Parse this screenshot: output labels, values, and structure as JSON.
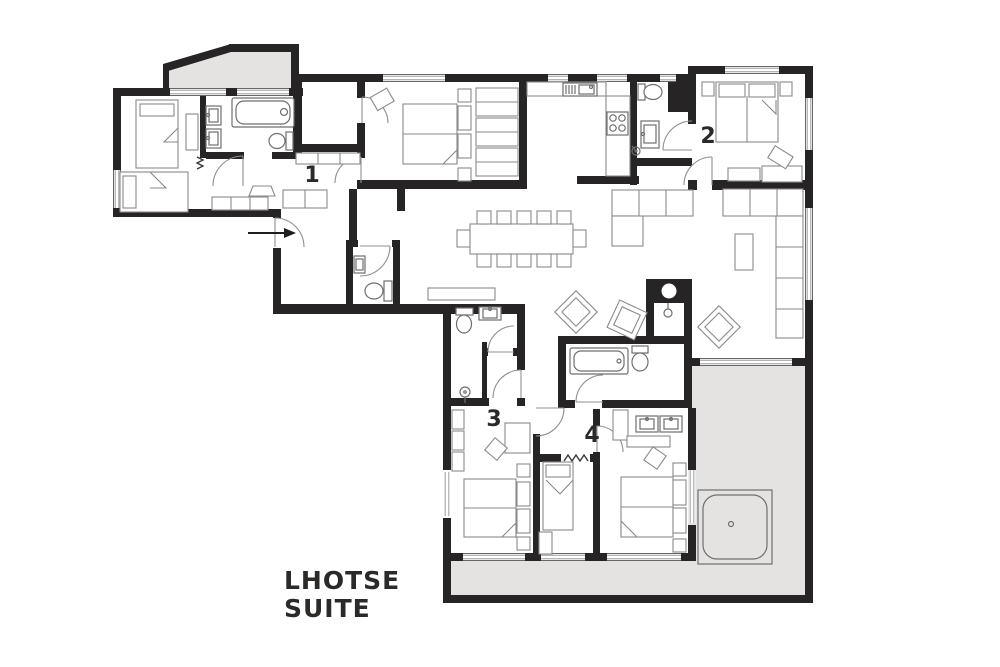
{
  "title": {
    "line1": "LHOTSE",
    "line2": "SUITE"
  },
  "rooms": [
    {
      "id": "bedroom-1",
      "label": "1"
    },
    {
      "id": "bedroom-2",
      "label": "2"
    },
    {
      "id": "bedroom-3",
      "label": "3"
    },
    {
      "id": "bedroom-4",
      "label": "4"
    }
  ],
  "colors": {
    "wall": "#272425",
    "terrace": "#e4e3e2",
    "furniture": "#8a8a8a",
    "text": "#2b2a29",
    "background": "#ffffff"
  },
  "features": [
    "entry-arrow",
    "balcony-terrace",
    "outdoor-terrace",
    "hot-tub",
    "fireplace",
    "dining-table-12-seats",
    "kitchen-sink",
    "stove",
    "bathtub",
    "shower",
    "toilet",
    "double-vanity",
    "double-bed",
    "single-bed",
    "sofa",
    "armchair",
    "wardrobe",
    "dressing-room",
    "wc"
  ]
}
